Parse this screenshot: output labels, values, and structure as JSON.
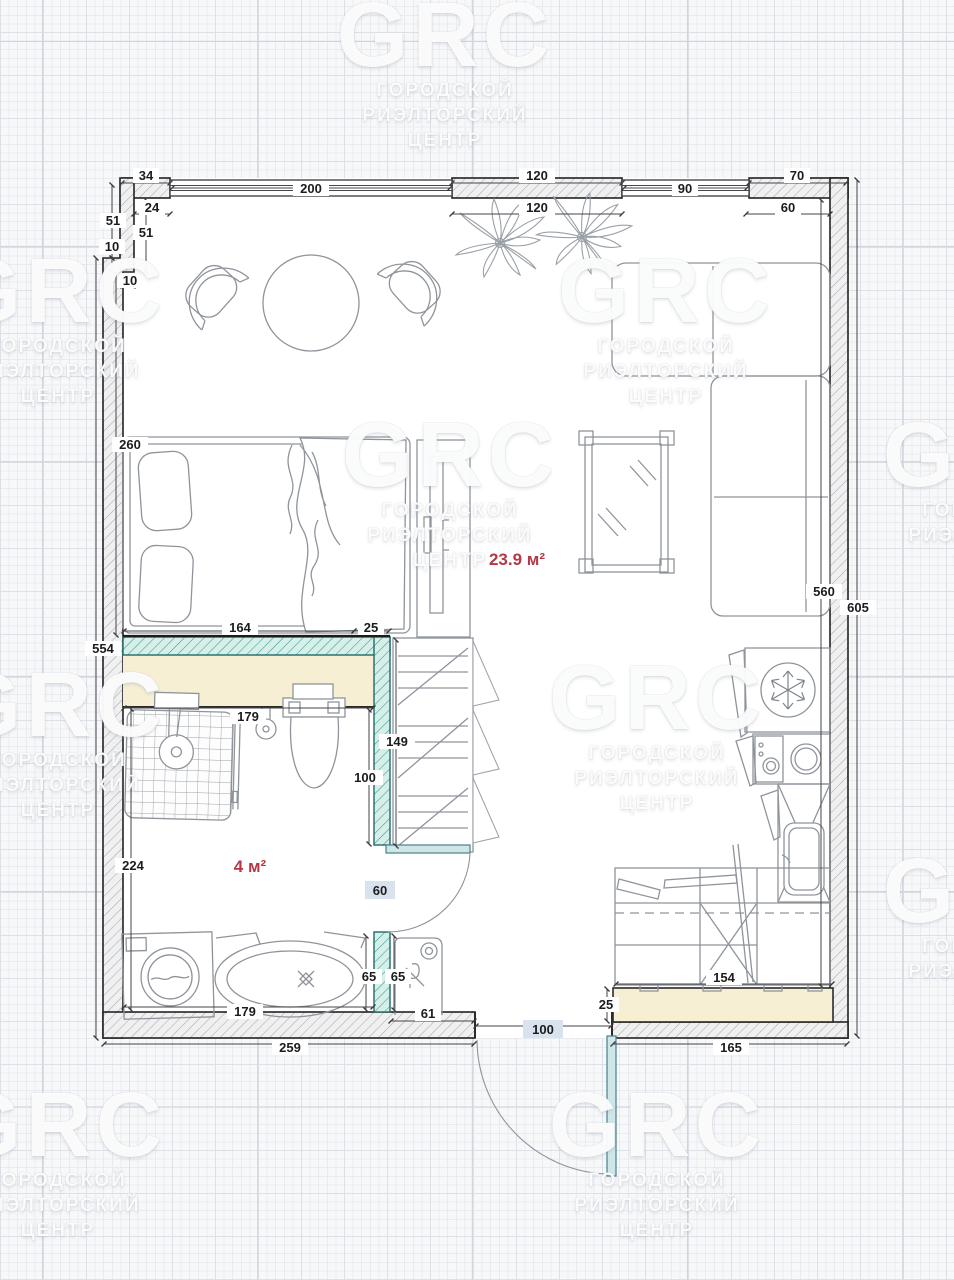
{
  "watermark": {
    "logo": "GRC",
    "line1": "ГОРОДСКОЙ",
    "line2": "РИЭЛТОРСКИЙ",
    "line3": "ЦЕНТР"
  },
  "rooms": {
    "living": "23.9 м²",
    "bath": "4 м²"
  },
  "colors": {
    "teal_wall": "#3a9a90",
    "teal_fill": "#d6efe9",
    "beige": "#f6efd4",
    "area_label": "#b43845",
    "door_leaf": "#cfe6e9",
    "chip_blue": "#d9e3ef"
  },
  "dims": {
    "d34": "34",
    "d200": "200",
    "d120a": "120",
    "d90": "90",
    "d70": "70",
    "d24": "24",
    "d120b": "120",
    "d60top": "60",
    "d51a": "51",
    "d10a": "10",
    "d51b": "51",
    "d10b": "10",
    "d260": "260",
    "d554": "554",
    "d224": "224",
    "d560": "560",
    "d605": "605",
    "d164": "164",
    "d25bed": "25",
    "d179top": "179",
    "d100bath": "100",
    "d179tub": "179",
    "d65a": "65",
    "d65b": "65",
    "d61": "61",
    "d259": "259",
    "d149": "149",
    "d60door": "60",
    "d100door": "100",
    "d154": "154",
    "d25k": "25",
    "d165": "165"
  }
}
